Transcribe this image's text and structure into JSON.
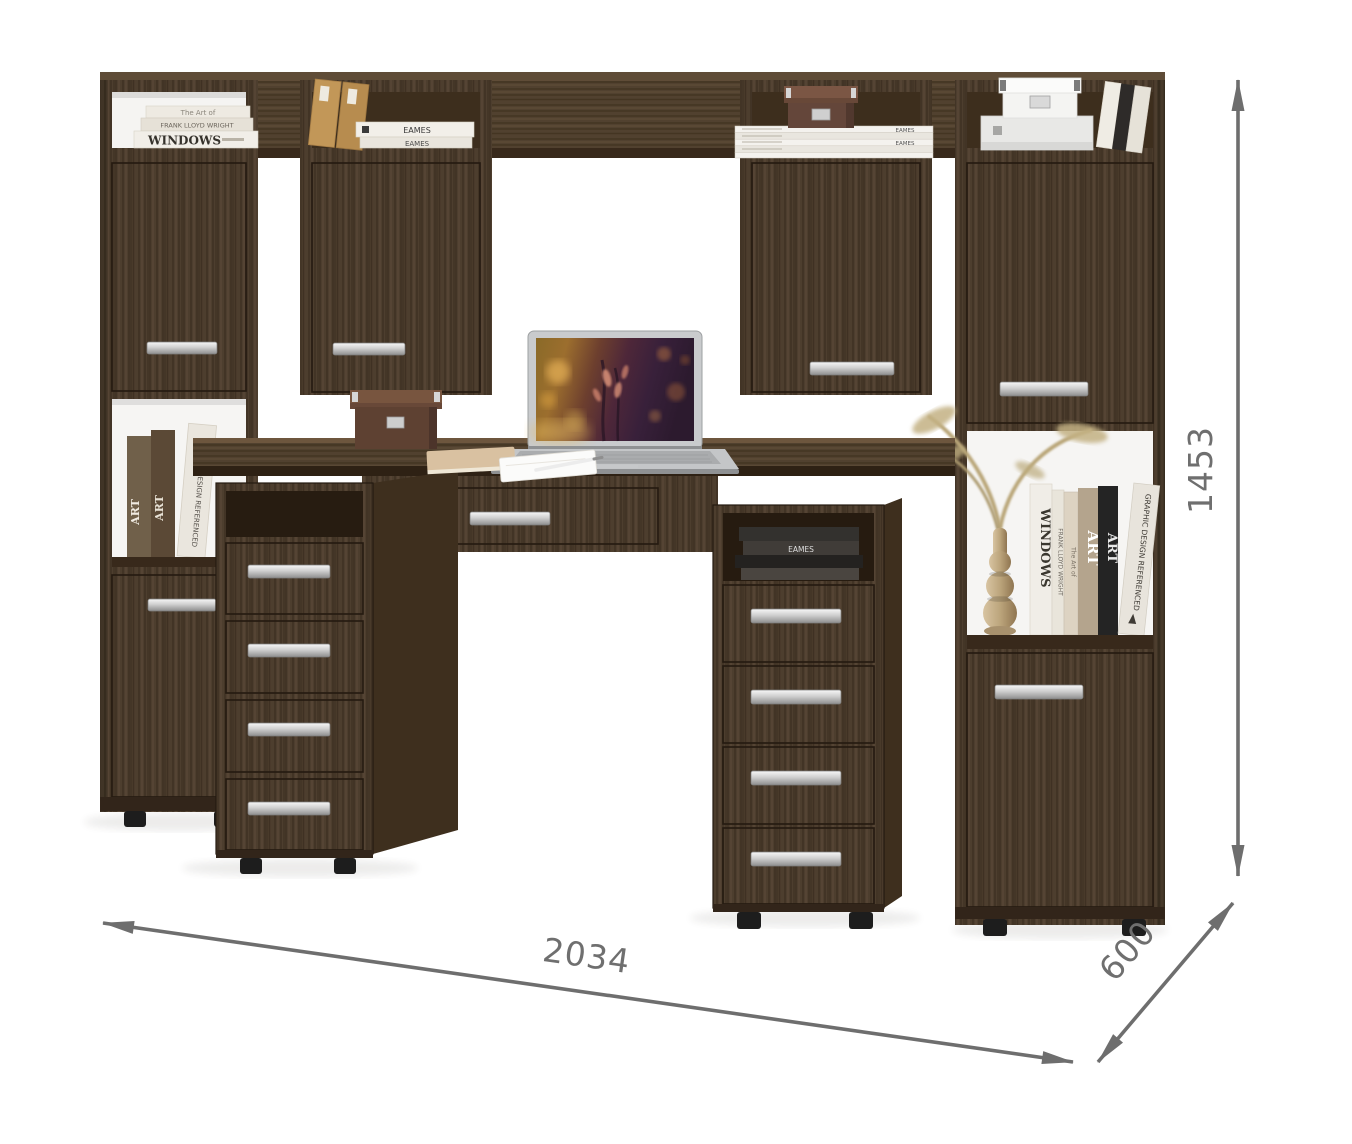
{
  "annotation": {
    "width_mm": "2034",
    "depth_mm": "600",
    "height_mm": "1453"
  },
  "colors": {
    "background": "#ffffff",
    "wood_base": "#4d3e2e",
    "wood_dark": "#38291b",
    "wood_interior": "#3d2e1d",
    "open_niche_white": "#f6f5f3",
    "handle_metal": "#d9d9d9",
    "foot_black": "#1d1d1d",
    "dimension_gray": "#6e6e6e",
    "box_brown": "#64463a",
    "box_white": "#f4f4f2",
    "vase_beige": "#c0a87f"
  },
  "decor": {
    "book_windows": "WINDOWS",
    "book_frank_lloyd_wright": "FRANK LLOYD WRIGHT",
    "book_eames": "EAMES",
    "book_art": "ART",
    "book_graphic_design": "GRAPHIC DESIGN REFERENCED",
    "book_the_art_of": "The Art of"
  }
}
